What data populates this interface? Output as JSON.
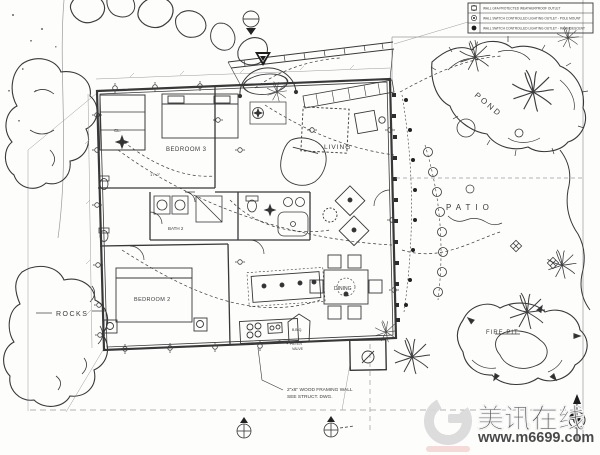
{
  "legend": {
    "rows": [
      {
        "symbol": "duplex-outlet-icon",
        "label": "WALL GFA PROTECTED WEATHERPROOF OUTLET"
      },
      {
        "symbol": "switched-pole-light-icon",
        "label": "WALL SWITCH CONTROLLED LIGHTING OUTLET - POLE MOUNT"
      },
      {
        "symbol": "switched-incandescent-icon",
        "label": "WALL SWITCH CONTROLLED LIGHTING OUTLET - INCANDESCENT"
      }
    ]
  },
  "rooms": {
    "bedroom3": "BEDROOM 3",
    "living": "LIVING",
    "bedroom2": "BEDROOM 2",
    "dining": "DINING",
    "bath2": "BATH 2",
    "closet": "CL.",
    "bbq": "B.B.Q."
  },
  "site": {
    "pond": "POND",
    "patio": "PATIO",
    "rocks": "ROCKS",
    "fire_pit": "FIRE PIT"
  },
  "notes": {
    "framing_line1": "2\"x6\" WOOD FRAMING WALL",
    "framing_line2": "SEE STRUCT. DWG.",
    "filter_line1": "FILTER",
    "filter_line2": "VALVE",
    "dim_corridor": "17'-0\""
  },
  "watermark": {
    "title": "美讯在线",
    "url": "www.m6699.com",
    "colors": {
      "logo": "#d9d9d9",
      "title_text": "#e3e3e3",
      "url_text": "#efcbc6"
    }
  },
  "colors": {
    "ink": "#383838",
    "paper": "#fdfdfc"
  }
}
